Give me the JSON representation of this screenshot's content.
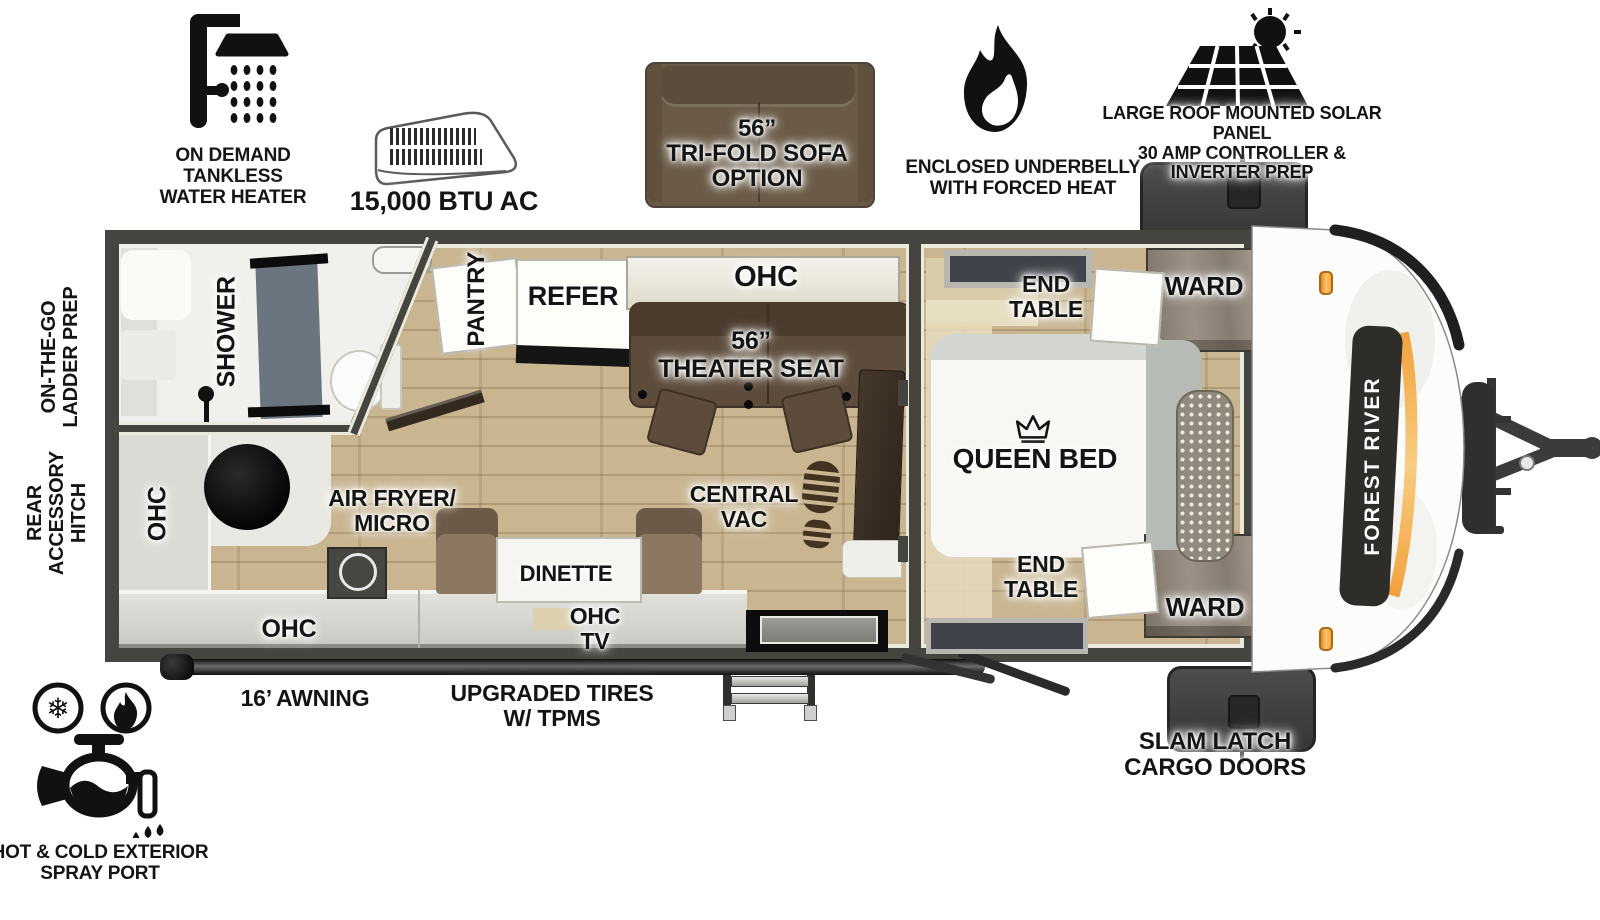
{
  "title": "Forest River travel trailer floor plan",
  "colors": {
    "wall": "#45443e",
    "floor_wood": "#c9b691",
    "accent_orange": "#f2a13c",
    "theater_brown": "#5d4c3b",
    "sofa_brown": "#6a5a47",
    "ward_wood": "#8d8378"
  },
  "features": {
    "water_heater": "ON DEMAND\nTANKLESS\nWATER HEATER",
    "ac": "15,000 BTU AC",
    "sofa": "56”\nTRI-FOLD SOFA\nOPTION",
    "underbelly": "ENCLOSED UNDERBELLY\nWITH FORCED HEAT",
    "solar": "LARGE ROOF MOUNTED SOLAR PANEL\n30 AMP CONTROLLER & INVERTER PREP"
  },
  "exterior": {
    "ladder_prep": "ON-THE-GO\nLADDER PREP",
    "rear_hitch": "REAR\nACCESSORY\nHITCH",
    "awning": "16’ AWNING",
    "tires": "UPGRADED TIRES\nW/ TPMS",
    "cargo_doors": "SLAM LATCH\nCARGO DOORS",
    "spray_port": "HOT & COLD EXTERIOR\nSPRAY PORT",
    "brand": "FOREST RIVER"
  },
  "rooms": {
    "shower": "SHOWER",
    "pantry": "PANTRY",
    "refer": "REFER",
    "ohc_galley": "OHC",
    "theater_seat": "56”\nTHEATER SEAT",
    "kitchen_ohc_left": "OHC",
    "air_fryer_micro": "AIR FRYER/\nMICRO",
    "kitchen_ohc_bottom": "OHC",
    "dinette": "DINETTE",
    "ohc_tv": "OHC\nTV",
    "central_vac": "CENTRAL\nVAC",
    "queen_bed": "QUEEN BED",
    "end_table_front": "END\nTABLE",
    "ward_front": "WARD",
    "end_table_rear": "END\nTABLE",
    "ward_rear": "WARD"
  }
}
